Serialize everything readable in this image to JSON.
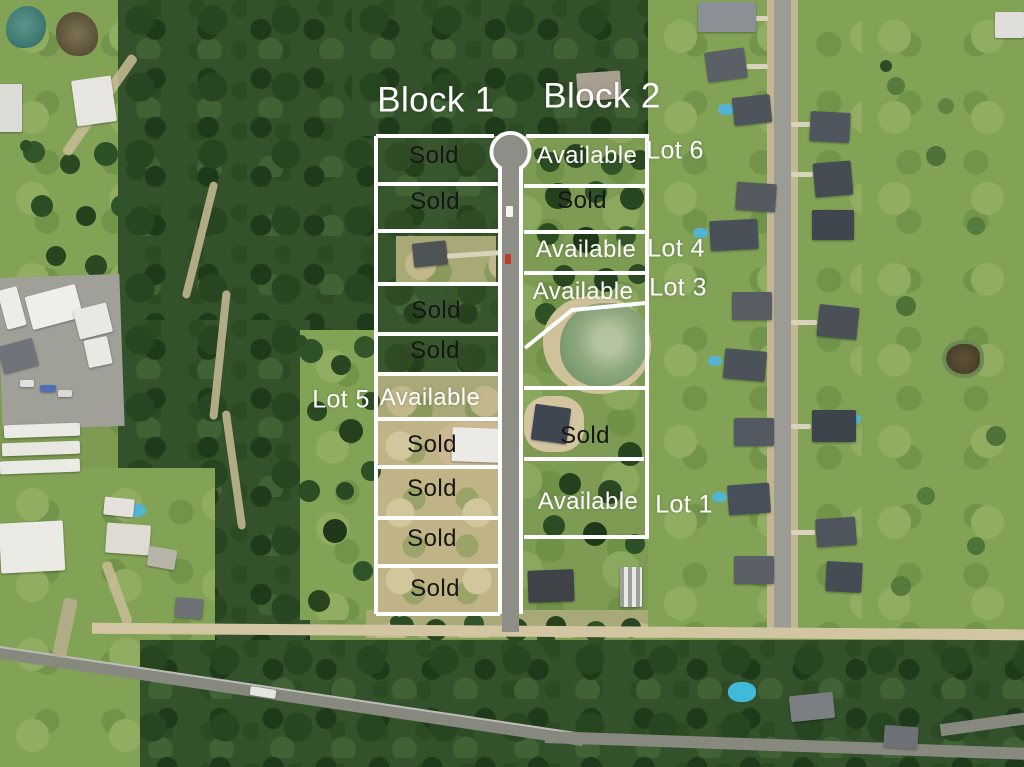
{
  "overlay": {
    "block_labels": [
      {
        "label": "Block 1"
      },
      {
        "label": "Block 2"
      }
    ],
    "block1_lots": [
      {
        "status": "Sold"
      },
      {
        "status": "Sold"
      },
      {
        "status": ""
      },
      {
        "status": "Sold"
      },
      {
        "status": "Sold"
      },
      {
        "status": "Available"
      },
      {
        "status": "Sold"
      },
      {
        "status": "Sold"
      },
      {
        "status": "Sold"
      },
      {
        "status": "Sold"
      }
    ],
    "block2_lots": [
      {
        "status": "Available"
      },
      {
        "status": "Sold"
      },
      {
        "status": "Available"
      },
      {
        "status": "Available"
      },
      {
        "status": "Sold"
      },
      {
        "status": "Available"
      }
    ],
    "lot_markers": [
      {
        "label": "Lot 6"
      },
      {
        "label": "Lot 4"
      },
      {
        "label": "Lot 3"
      },
      {
        "label": "Lot 5"
      },
      {
        "label": "Lot 1"
      }
    ],
    "colors": {
      "lot_line": "#ffffff",
      "sold_text": "#161616",
      "available_text": "#ffffff",
      "block_text": "#ffffff",
      "road_gray": "#8d8f86",
      "forest_green": "#33512a",
      "field_green": "#82a356",
      "dry_tan": "#c0b386"
    }
  }
}
